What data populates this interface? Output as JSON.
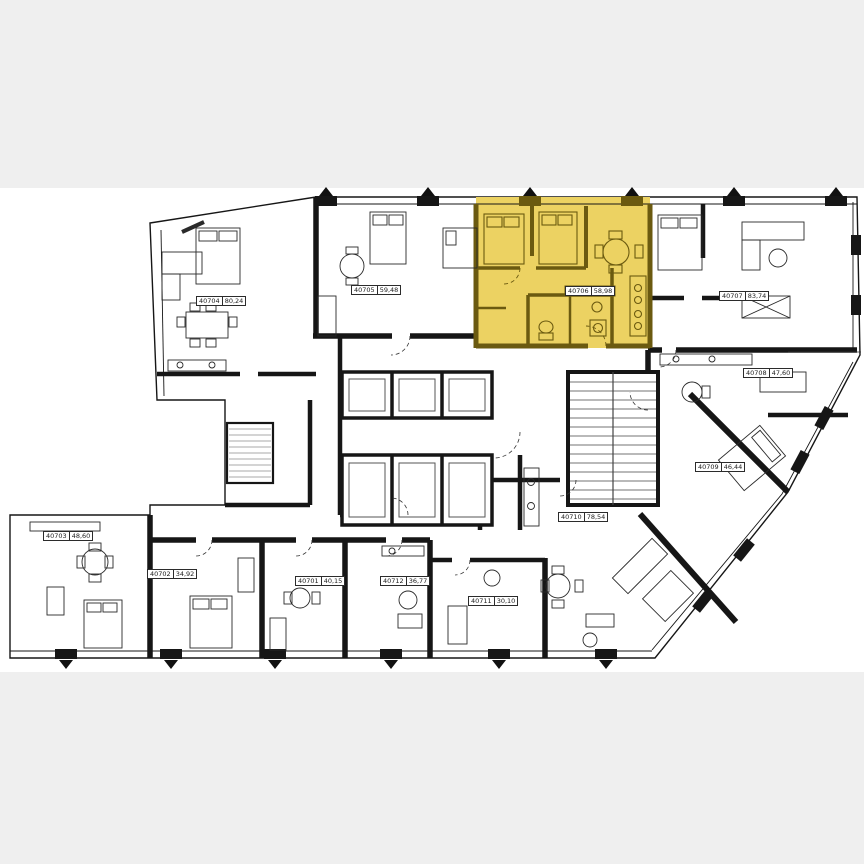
{
  "page": {
    "type": "residential-floor-plan-viewer"
  },
  "plan": {
    "background_color": "#ffffff",
    "margin_band_color": "#efefef",
    "wall_color": "#161616",
    "selected_unit": {
      "number": "40706",
      "area": "58,98",
      "fill_color": "#ecd262",
      "wall_color": "#6b5a10"
    },
    "apartments": [
      {
        "number": "40701",
        "area": "40,15"
      },
      {
        "number": "40702",
        "area": "34,92"
      },
      {
        "number": "40703",
        "area": "48,60"
      },
      {
        "number": "40704",
        "area": "80,24"
      },
      {
        "number": "40705",
        "area": "59,48"
      },
      {
        "number": "40706",
        "area": "58,98"
      },
      {
        "number": "40707",
        "area": "83,74"
      },
      {
        "number": "40708",
        "area": "47,60"
      },
      {
        "number": "40709",
        "area": "46,44"
      },
      {
        "number": "40710",
        "area": "78,54"
      },
      {
        "number": "40711",
        "area": "30,10"
      },
      {
        "number": "40712",
        "area": "36,77"
      }
    ]
  }
}
